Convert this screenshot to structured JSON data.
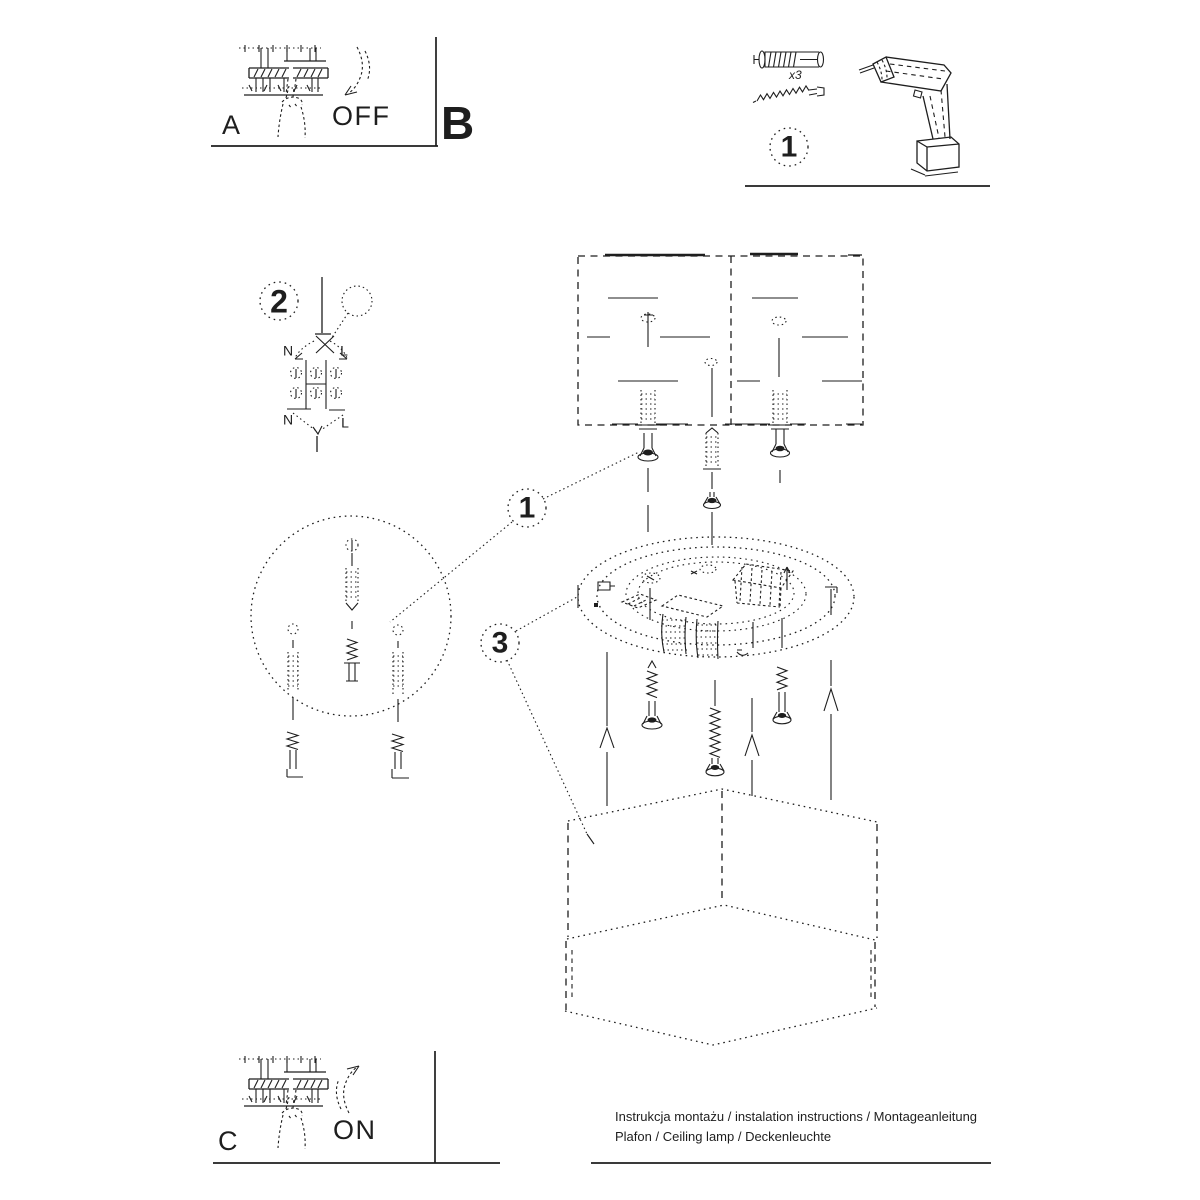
{
  "colors": {
    "ink": "#1e1e1e",
    "paper": "#ffffff"
  },
  "panels": {
    "a": {
      "label": "A",
      "state": "OFF"
    },
    "b": {
      "label": "B"
    },
    "c": {
      "label": "C",
      "state": "ON"
    }
  },
  "steps": {
    "tools": {
      "number": "1",
      "plug_quantity": "x3"
    },
    "wiring": {
      "number": "2"
    }
  },
  "callouts": {
    "wall_plug_detail": "1",
    "shade_mounting": "3"
  },
  "wiring_labels": {
    "top_n": "N",
    "top_l": "L",
    "bottom_n": "N",
    "bottom_l": "L"
  },
  "footer": {
    "title_line": "Instrukcja montażu / instalation instructions / Montageanleitung",
    "product_line": "Plafon / Ceiling lamp / Deckenleuchte"
  },
  "icons": {
    "panel_a": "fusebox-hand-off-icon",
    "panel_c": "fusebox-hand-on-icon",
    "tools": [
      "wall-plug-icon",
      "screw-icon",
      "drill-icon"
    ],
    "diagram": [
      "ceiling-section",
      "mounting-plate",
      "hexagonal-shade",
      "magnifier-icon"
    ]
  }
}
